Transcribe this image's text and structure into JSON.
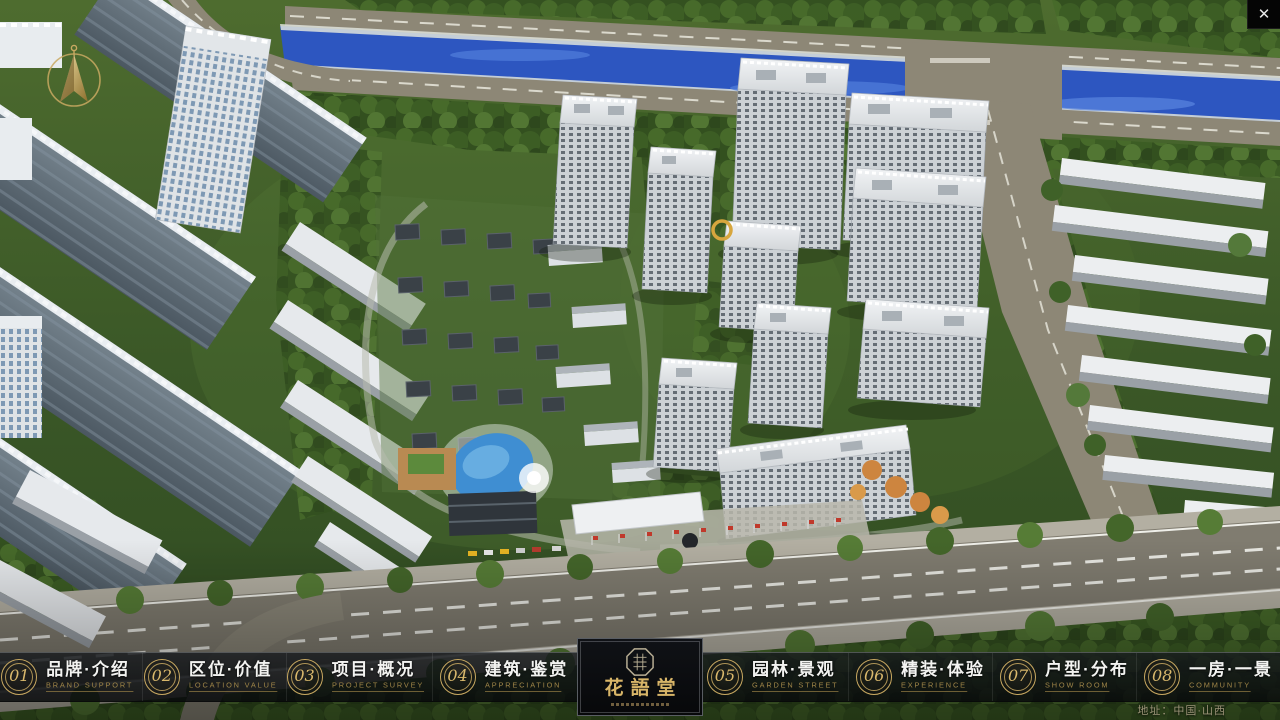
{
  "window": {
    "close_glyph": "✕"
  },
  "palette": {
    "gold": "#c9a961",
    "gold_dark": "#a08648",
    "logo_gold": "#d8b568",
    "nav_bg": "#0c0e10",
    "river_blue": "#2d56c0",
    "tree_green": "#3c5d24"
  },
  "nav": {
    "items": [
      {
        "num": "01",
        "zh": "品牌·介绍",
        "en": "BRAND SUPPORT"
      },
      {
        "num": "02",
        "zh": "区位·价值",
        "en": "LOCATION VALUE"
      },
      {
        "num": "03",
        "zh": "项目·概况",
        "en": "PROJECT SURVEY"
      },
      {
        "num": "04",
        "zh": "建筑·鉴赏",
        "en": "APPRECIATION"
      },
      {
        "num": "05",
        "zh": "园林·景观",
        "en": "GARDEN STREET"
      },
      {
        "num": "06",
        "zh": "精装·体验",
        "en": "EXPERIENCE"
      },
      {
        "num": "07",
        "zh": "户型·分布",
        "en": "SHOW ROOM"
      },
      {
        "num": "08",
        "zh": "一房·一景",
        "en": "COMMUNITY"
      }
    ]
  },
  "logo": {
    "title": "花語堂"
  },
  "footer": {
    "address": "地址：中国·山西"
  }
}
